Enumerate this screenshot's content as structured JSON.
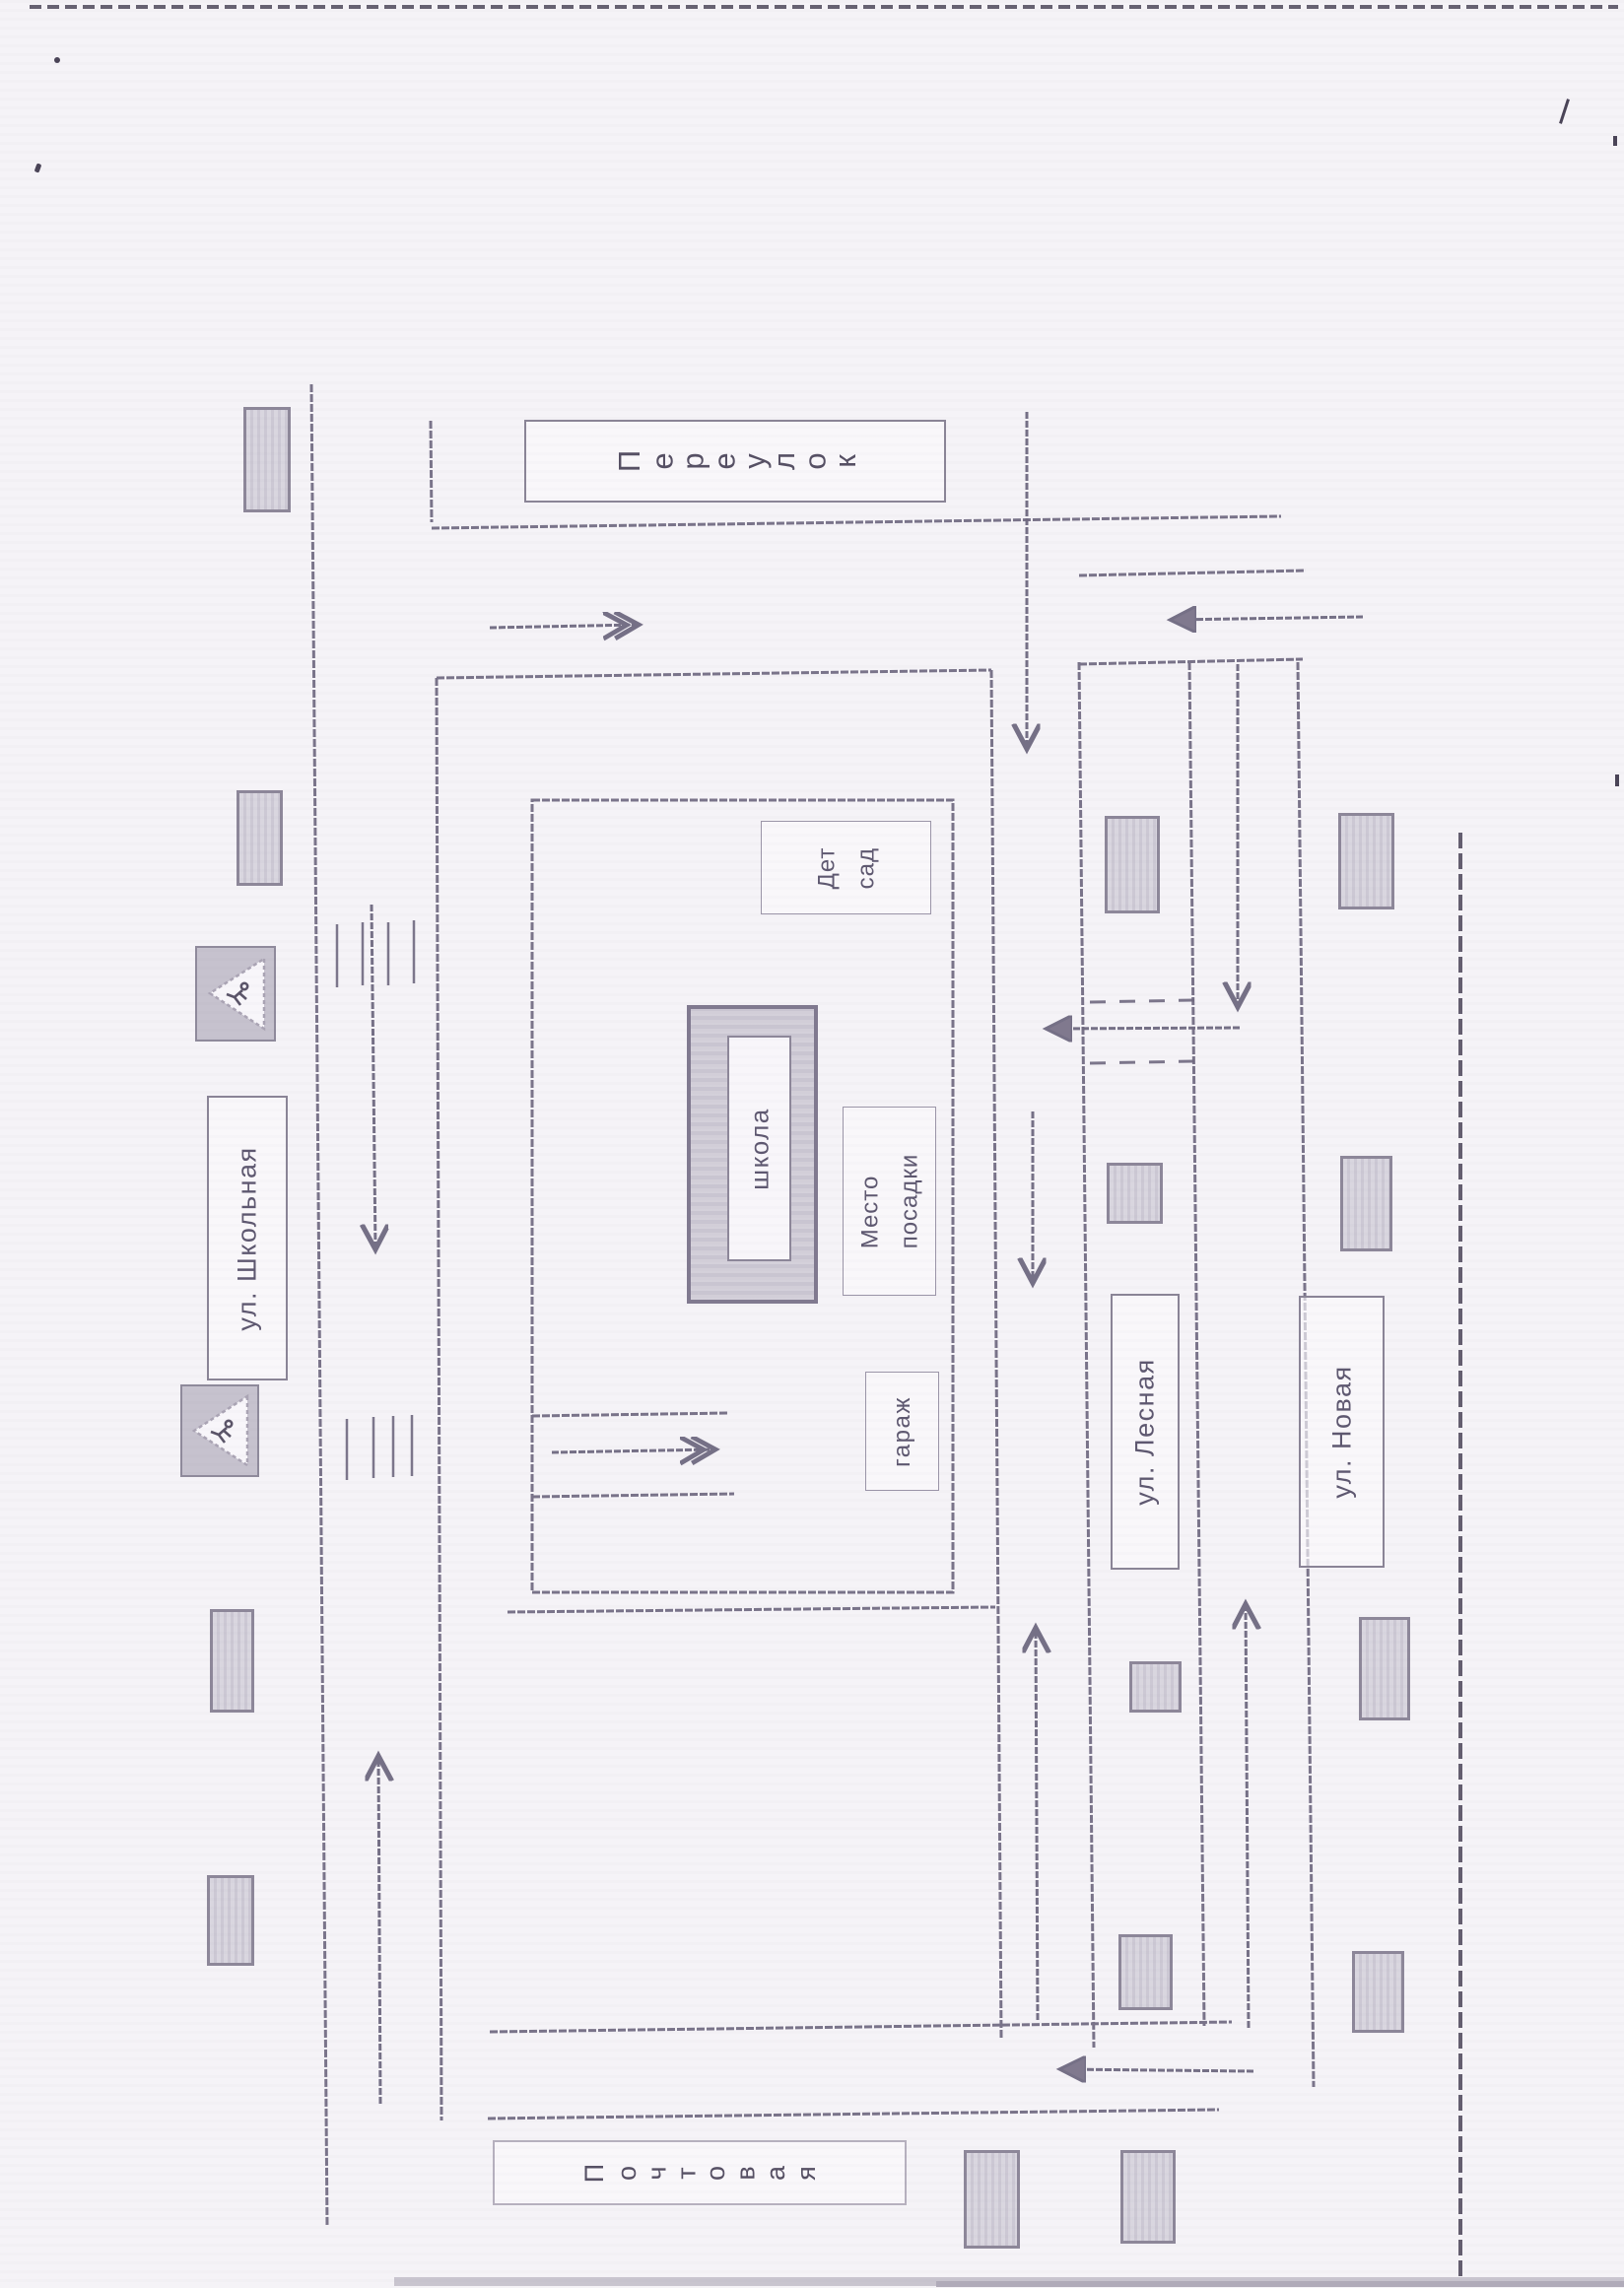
{
  "scene": {
    "background": "#f5f3f7",
    "ink": "#6f6980",
    "house_fill": "#ccc8d4",
    "house_border": "#8d8799",
    "sign_fill": "#c6c2ce",
    "sign_triangle": "#f8f6fa",
    "text_color": "#5e5870"
  },
  "streets": {
    "pereulok": "Переулок",
    "shkolnaya": "ул. Школьная",
    "lesnaya": "ул. Лесная",
    "novaya": "ул. Новая",
    "pochtovaya": "Почтовая"
  },
  "places": {
    "school": "школа",
    "kindergarten": [
      "Дет",
      "сад"
    ],
    "boarding_point": [
      "Место",
      "посадки"
    ],
    "garage": "гараж"
  },
  "icons": {
    "sign_upper": "pedestrian-crossing-sign",
    "sign_lower": "pedestrian-crossing-sign"
  }
}
